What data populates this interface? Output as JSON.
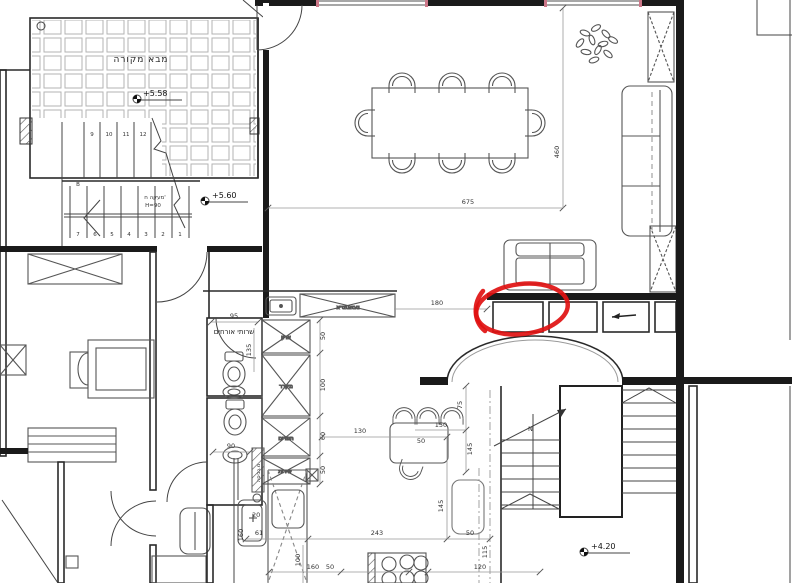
{
  "colors": {
    "annotation": "#e01111",
    "walls": "#1a1a1a",
    "dimension": "#555555",
    "window": "#8a8a8a"
  },
  "rooms": {
    "entry_porch": "מבא מקורה",
    "guest_wc": "שרותי אורחים"
  },
  "kitchen": {
    "counter_label": "א.מחייבים",
    "closet": "ארון",
    "fridge": "מקרר",
    "ovens": "תנורים",
    "service": "שירות",
    "laundry": "מ.כביסה"
  },
  "stairs_top": {
    "upper_numbers": [
      "9",
      "10",
      "11",
      "12"
    ],
    "lower_numbers": [
      "7",
      "6",
      "5",
      "4",
      "3",
      "2",
      "1"
    ],
    "landing": "B",
    "railing": "מעקה ח'",
    "railing_height": "H=90"
  },
  "stairs_bottom": {
    "direction_label": "N"
  },
  "levels": {
    "porch": "+5.58",
    "hall": "+5.60",
    "lower": "+4.20"
  },
  "dims": {
    "dining_width": "675",
    "dining_depth": "460",
    "opening": "180",
    "wc_width": "95",
    "wc_depth": "135",
    "wc2_width": "90",
    "closet_h": "50",
    "fridge_h": "100",
    "ovens_h": "60",
    "service_h": "50",
    "aisle": "130",
    "bar_len": "150",
    "bar_depth": "75",
    "bar_right": "145",
    "bar_gap": "50",
    "island_side": "145",
    "laundry_w": "20",
    "counter_gap": "61",
    "run": "243",
    "stove_gap": "50",
    "bottom_a": "160",
    "bottom_b": "50",
    "right_width": "120",
    "right_depth": "115",
    "island_w": "100",
    "island_d": "160"
  }
}
